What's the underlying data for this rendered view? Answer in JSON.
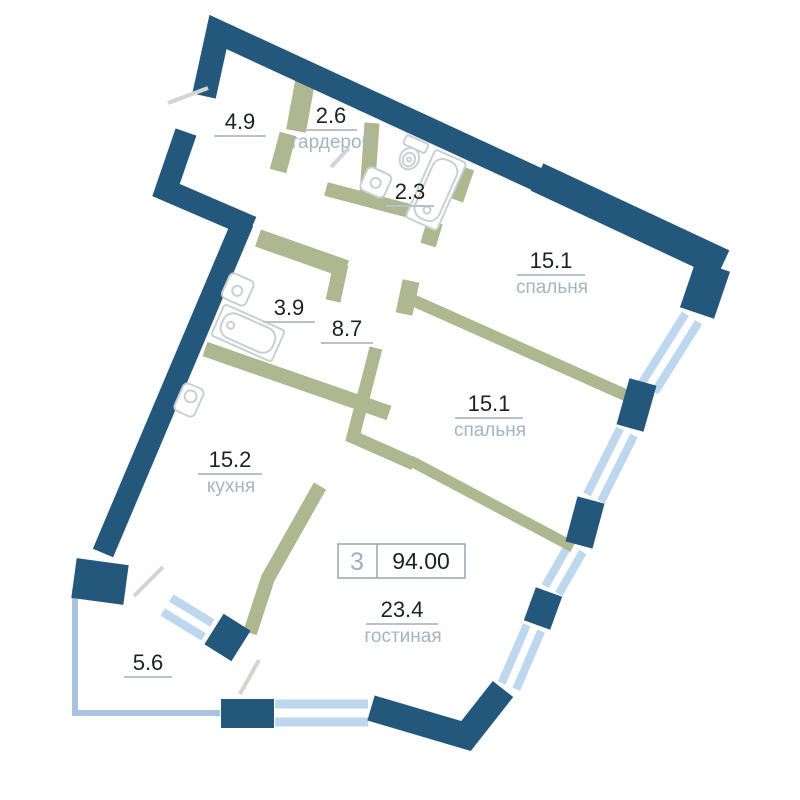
{
  "plan_title": "apartment floor plan",
  "badge": {
    "rooms_count": "3",
    "total_area": "94.00"
  },
  "rooms": [
    {
      "key": "entry-hall",
      "area": "4.9",
      "name": ""
    },
    {
      "key": "wardrobe",
      "area": "2.6",
      "name": "гардероб"
    },
    {
      "key": "wc",
      "area": "2.3",
      "name": ""
    },
    {
      "key": "bedroom-1",
      "area": "15.1",
      "name": "спальня"
    },
    {
      "key": "bathroom",
      "area": "3.9",
      "name": ""
    },
    {
      "key": "hallway",
      "area": "8.7",
      "name": ""
    },
    {
      "key": "bedroom-2",
      "area": "15.1",
      "name": "спальня"
    },
    {
      "key": "kitchen",
      "area": "15.2",
      "name": "кухня"
    },
    {
      "key": "living-room",
      "area": "23.4",
      "name": "гостиная"
    },
    {
      "key": "balcony",
      "area": "5.6",
      "name": ""
    }
  ],
  "fixtures": [
    "toilet",
    "sink",
    "bathtub",
    "sink",
    "bathtub",
    "kitchen-sink"
  ],
  "colors": {
    "wall": "#23587c",
    "partition": "#aeb78f",
    "window": "#bdd7ee",
    "window_gap": "#ffffff",
    "balcony_glazing": "#a7c3e0",
    "area_number": "#1d2126",
    "room_name": "#a6b3c1",
    "underline": "#b9c2ca",
    "badge_border": "#97a5b0",
    "badge_rooms": "#9fb0bf",
    "fixture_outline": "#cbcfd2",
    "door": "#d6d4d2"
  }
}
